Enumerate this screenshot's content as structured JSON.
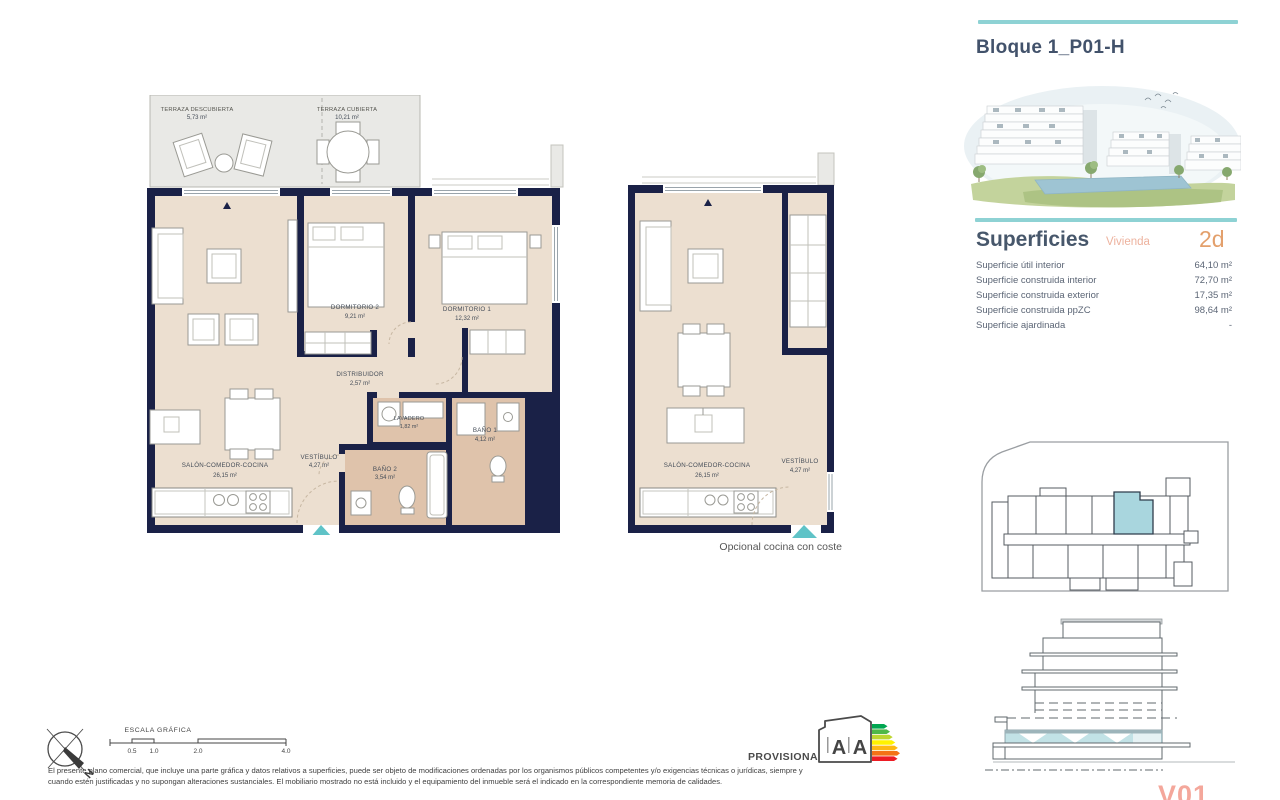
{
  "header": {
    "title": "Bloque 1_P01-H"
  },
  "superficies": {
    "heading": "Superficies",
    "vivienda_label": "Vivienda",
    "vivienda_code": "2d",
    "rows": [
      {
        "label": "Superficie útil interior",
        "value": "64,10 m²"
      },
      {
        "label": "Superficie construida interior",
        "value": "72,70 m²"
      },
      {
        "label": "Superficie construida exterior",
        "value": "17,35 m²"
      },
      {
        "label": "Superficie construida ppZC",
        "value": "98,64 m²"
      },
      {
        "label": "Superficie ajardinada",
        "value": "-"
      }
    ]
  },
  "plan_main": {
    "rooms": {
      "terraza_descubierta": {
        "name": "TERRAZA DESCUBIERTA",
        "area": "5,73 m²"
      },
      "terraza_cubierta": {
        "name": "TERRAZA CUBIERTA",
        "area": "10,21 m²"
      },
      "dormitorio2": {
        "name": "DORMITORIO 2",
        "area": "9,21 m²"
      },
      "dormitorio1": {
        "name": "DORMITORIO 1",
        "area": "12,32 m²"
      },
      "distribuidor": {
        "name": "DISTRIBUIDOR",
        "area": "2,57 m²"
      },
      "lavadero": {
        "name": "LAVADERO",
        "area": "1,82 m²"
      },
      "bano1": {
        "name": "BAÑO 1",
        "area": "4,12 m²"
      },
      "bano2": {
        "name": "BAÑO 2",
        "area": "3,54 m²"
      },
      "vestibulo": {
        "name": "VESTÍBULO",
        "area": "4,27 m²"
      },
      "salon": {
        "name": "SALÓN-COMEDOR-COCINA",
        "area": "26,15 m²"
      }
    }
  },
  "plan_alt": {
    "salon": {
      "name": "SALÓN-COMEDOR-COCINA",
      "area": "26,15 m²"
    },
    "vestibulo": {
      "name": "VESTÍBULO",
      "area": "4,27 m²"
    },
    "caption": "Opcional cocina con coste"
  },
  "footer": {
    "escala_label": "ESCALA GRÁFICA",
    "scale_ticks": [
      "0.5",
      "1.0",
      "2.0",
      "4.0"
    ],
    "compass_n": "N",
    "provisional": "PROVISIONAL",
    "disclaimer1": "El presente plano comercial, que incluye una parte gráfica y datos relativos a superficies, puede ser objeto de modificaciones ordenadas por los organismos públicos competentes y/o exigencias técnicas o jurídicas, siempre y",
    "disclaimer2": "cuando estén justificadas y no supongan alteraciones sustanciales. El mobiliario mostrado no está incluido y el equipamiento del inmueble será el indicado en la correspondiente memoria de calidades."
  },
  "energy": {
    "letters": [
      "A",
      "A"
    ],
    "scale_colors": [
      "#00a651",
      "#50b848",
      "#bed630",
      "#fff200",
      "#fdb913",
      "#f47216",
      "#ed1c24"
    ]
  },
  "watermark": {
    "text": "V01"
  },
  "colors": {
    "wall_navy": "#1a2147",
    "floor": "#ecdfd0",
    "floor_wet": "#dfc3ab",
    "terrace": "#e9e9e6",
    "accent_teal": "#8ed2d4",
    "entry_teal": "#5fc3c7",
    "highlight_unit": "#a9d6de"
  }
}
